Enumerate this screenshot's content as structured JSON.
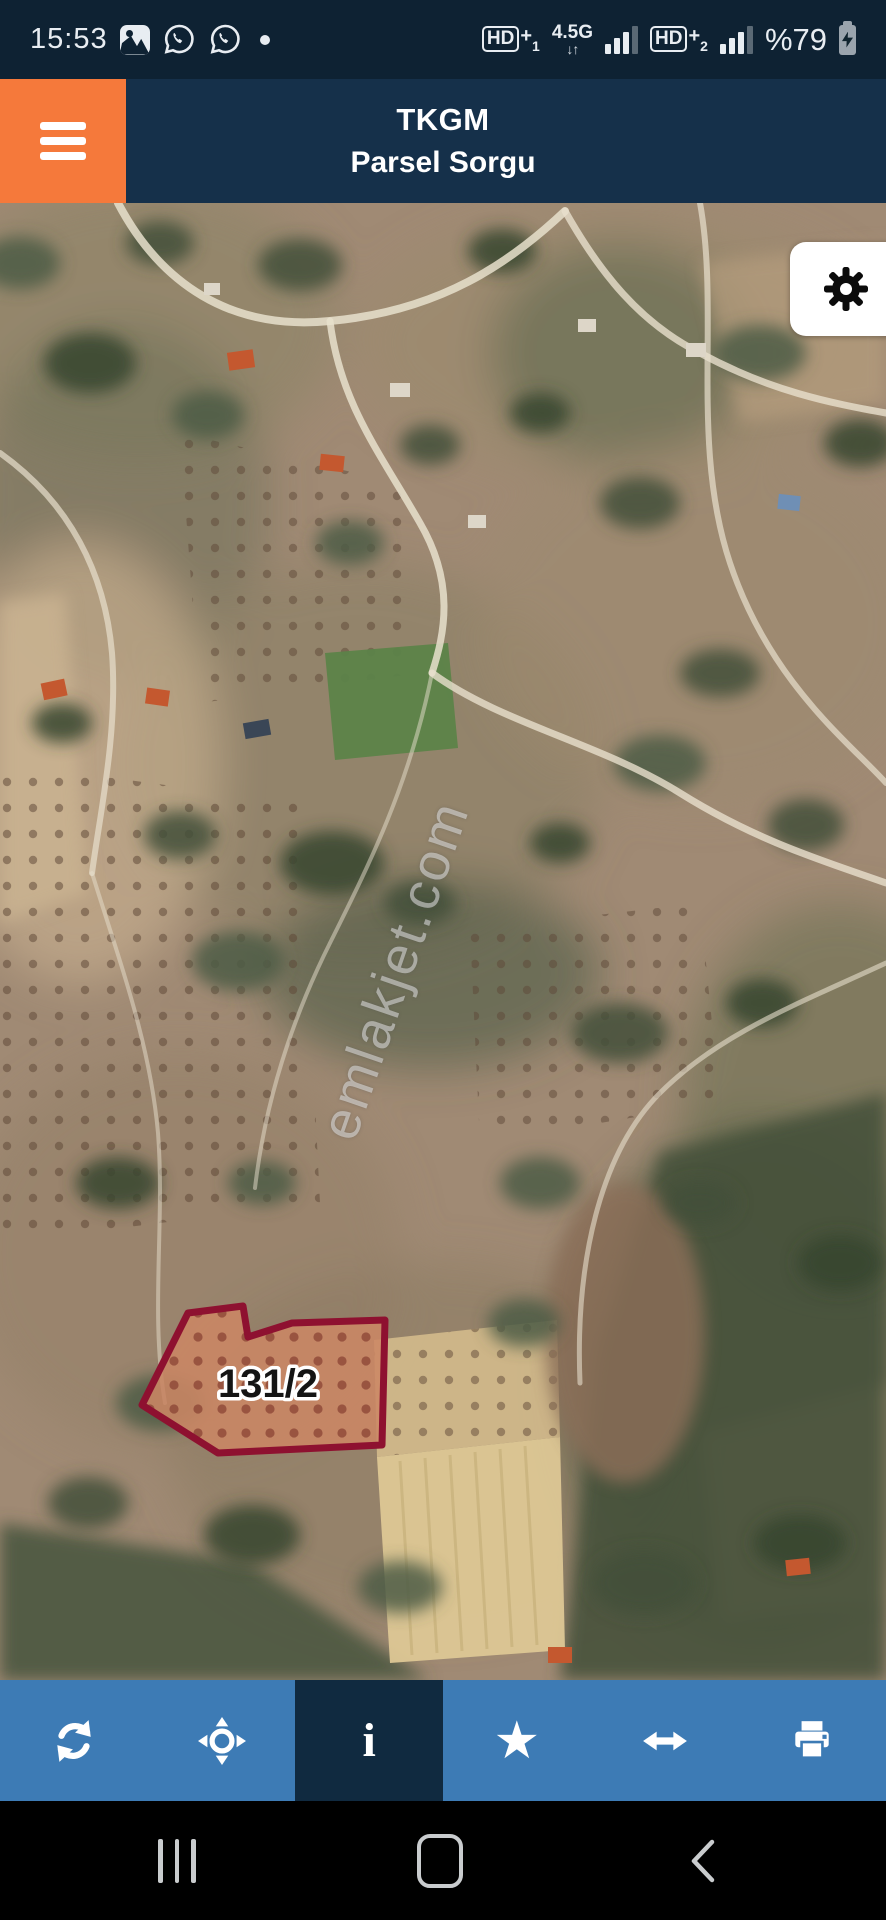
{
  "status_bar": {
    "time": "15:53",
    "notification_icons": [
      "gallery-icon",
      "whatsapp-icon",
      "whatsapp-icon",
      "notification-dot"
    ],
    "sim1": {
      "label": "HD",
      "plus": "+",
      "sub": "1"
    },
    "network_type": "4.5G",
    "network_arrows": "↓↑",
    "sim2": {
      "label": "HD",
      "plus": "+",
      "sub": "2"
    },
    "battery": {
      "percent_label": "%79",
      "charging": true
    }
  },
  "header": {
    "app_title": "TKGM",
    "subtitle": "Parsel Sorgu"
  },
  "map": {
    "type": "satellite-imagery",
    "parcel": {
      "label": "131/2",
      "outline_color": "#8e1130"
    },
    "watermark": "emlakjet.com",
    "settings_button_icon": "gear-icon"
  },
  "toolbar": {
    "items": [
      {
        "icon": "refresh-icon",
        "active": false
      },
      {
        "icon": "locate-crosshair-icon",
        "active": false
      },
      {
        "icon": "info-icon",
        "active": true
      },
      {
        "icon": "favorite-star-icon",
        "active": false
      },
      {
        "icon": "measure-arrows-icon",
        "active": false
      },
      {
        "icon": "print-icon",
        "active": false
      }
    ],
    "info_glyph": "i",
    "star_glyph": "★"
  },
  "nav_bar": {
    "buttons": [
      "recents",
      "home",
      "back"
    ]
  },
  "colors": {
    "accent_orange": "#f5793b",
    "status_bar_bg": "#0e2233",
    "header_bg": "#15304a",
    "toolbar_blue": "#3d7bb5",
    "toolbar_active": "#102a40",
    "parcel_stroke": "#8e1130",
    "nav_bar_bg": "#000000"
  }
}
